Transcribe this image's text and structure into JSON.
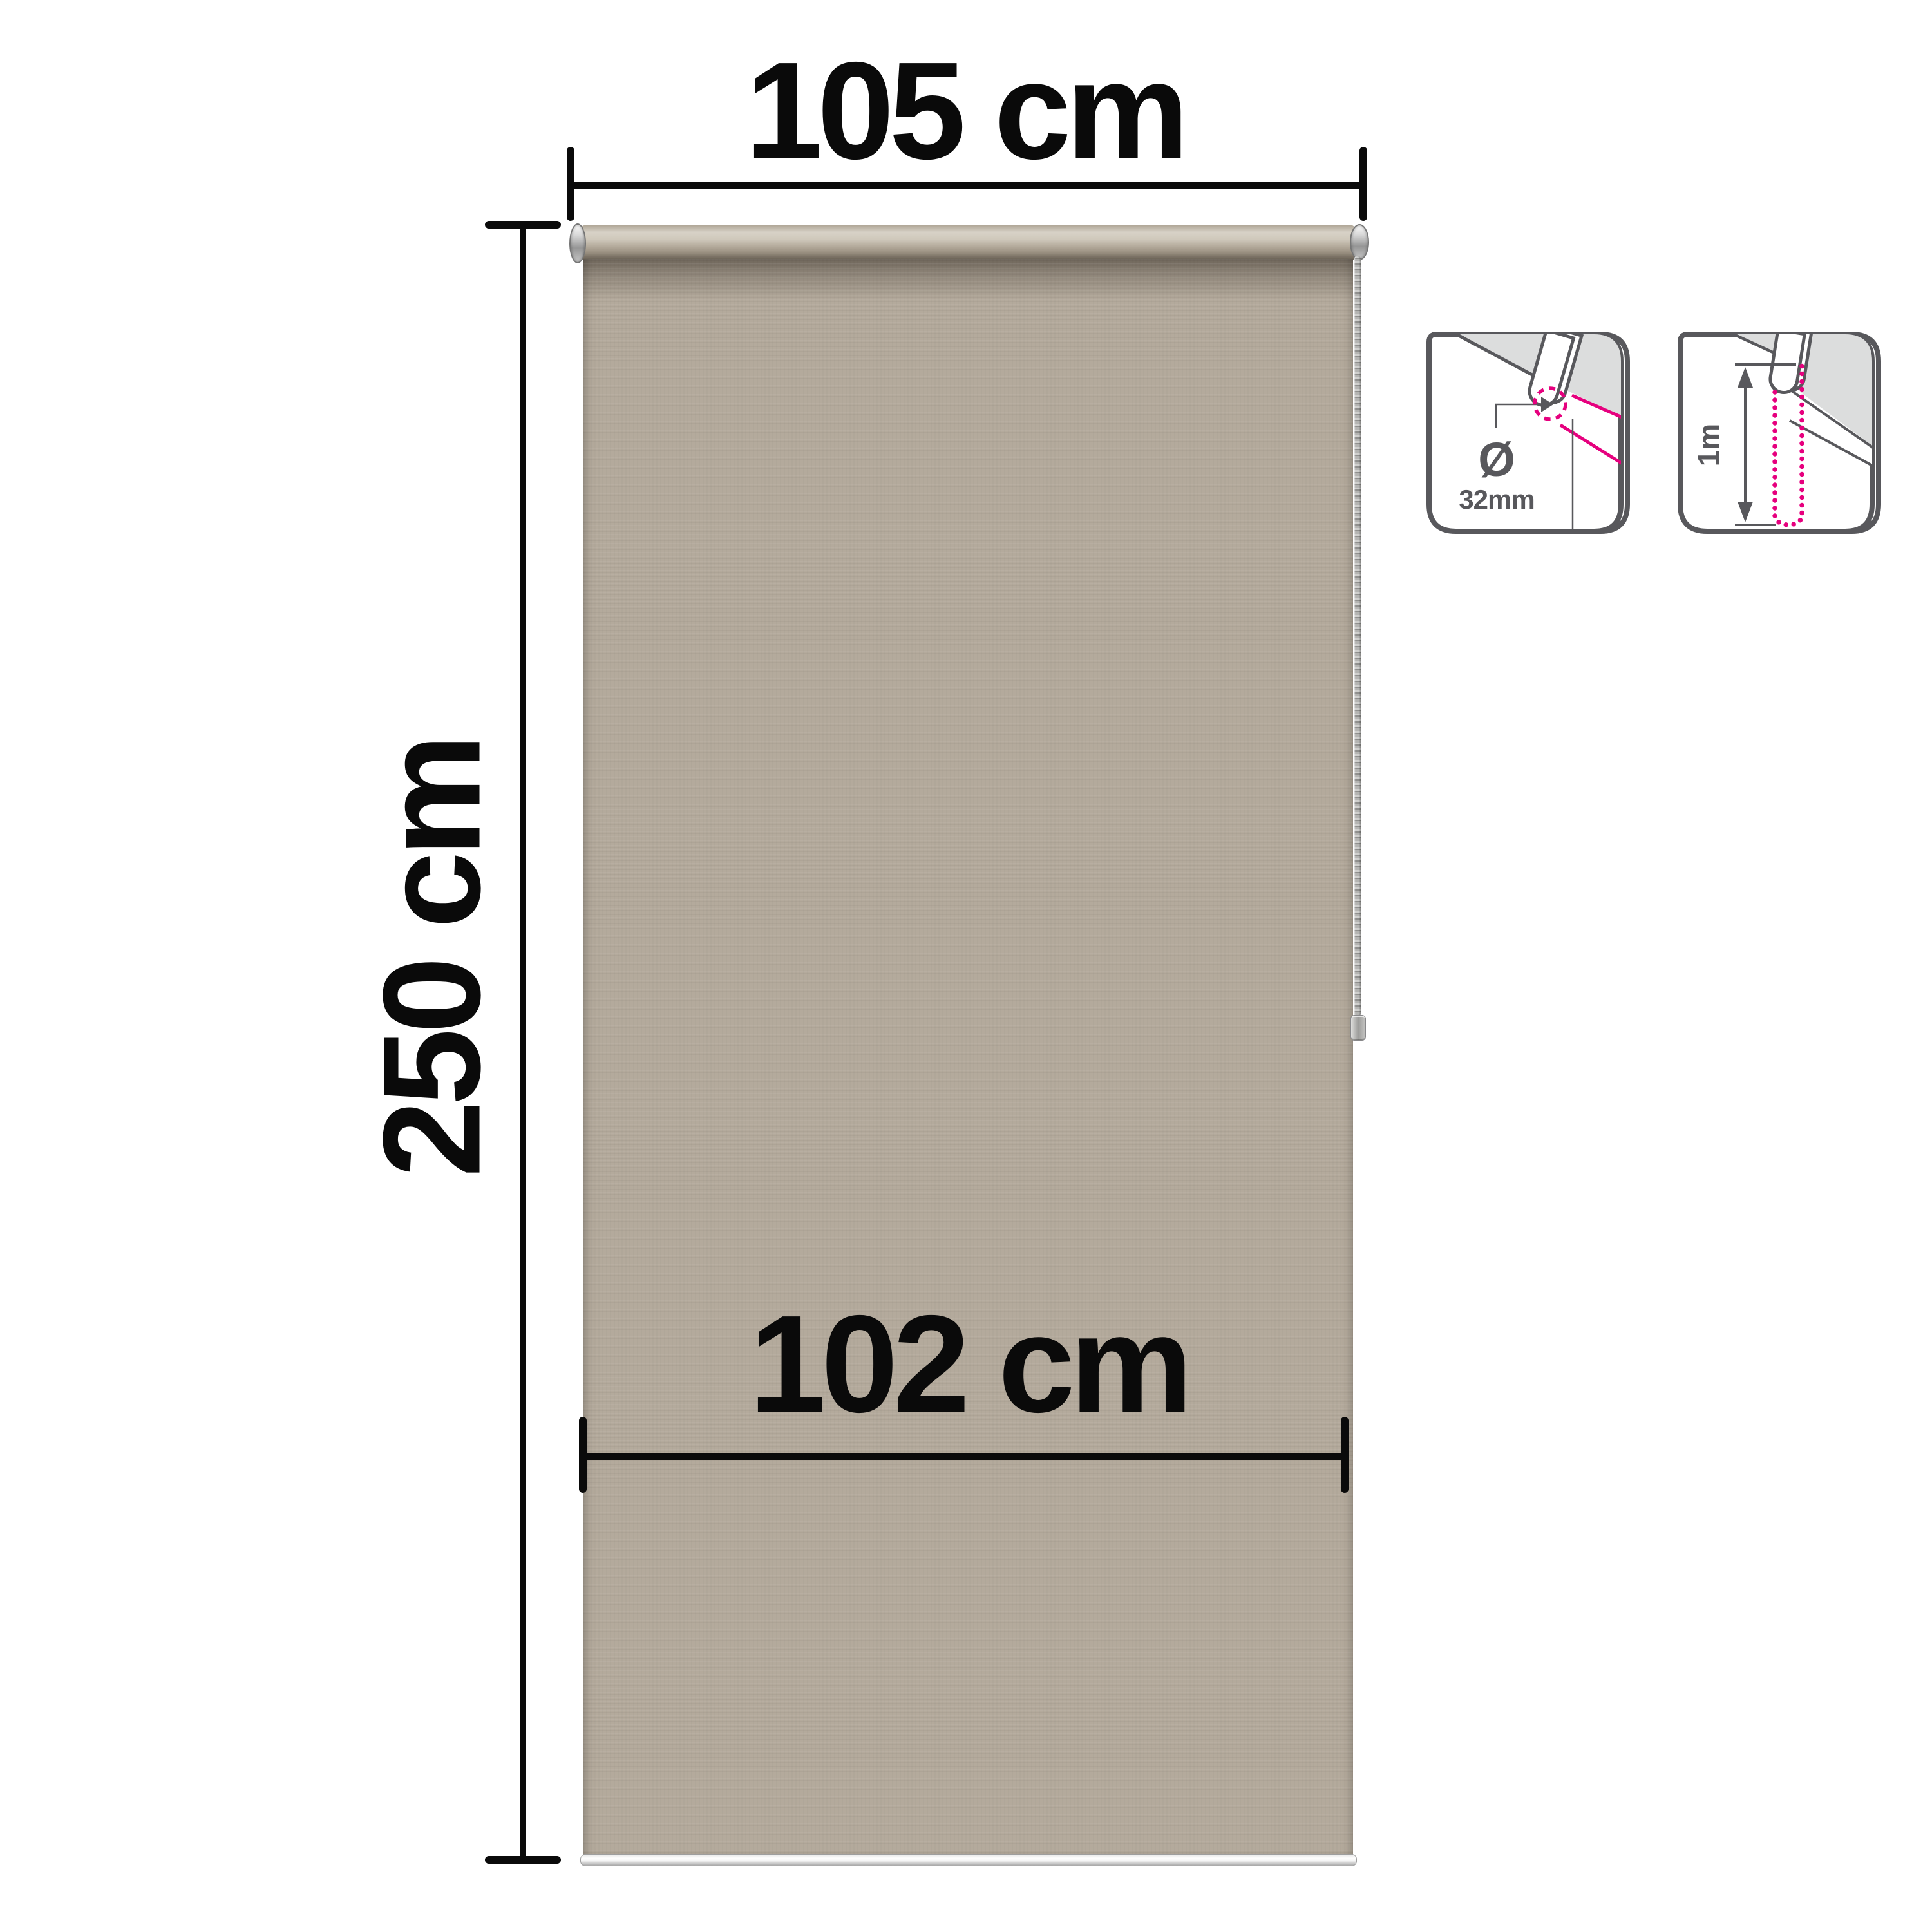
{
  "diagram": {
    "labels": {
      "total_width": "105 cm",
      "total_height": "250 cm",
      "fabric_width": "102 cm"
    },
    "icons": {
      "tube_diameter": {
        "symbol": "Ø",
        "value": "32mm"
      },
      "chain_drop": {
        "value": "1m"
      }
    },
    "colors": {
      "dimension_black": "#0a0a0a",
      "fabric_beige": "#b4aa9c",
      "icon_outline_gray": "#58585c",
      "icon_fill_gray": "#dcdddd",
      "accent_pink": "#e6007e"
    }
  }
}
